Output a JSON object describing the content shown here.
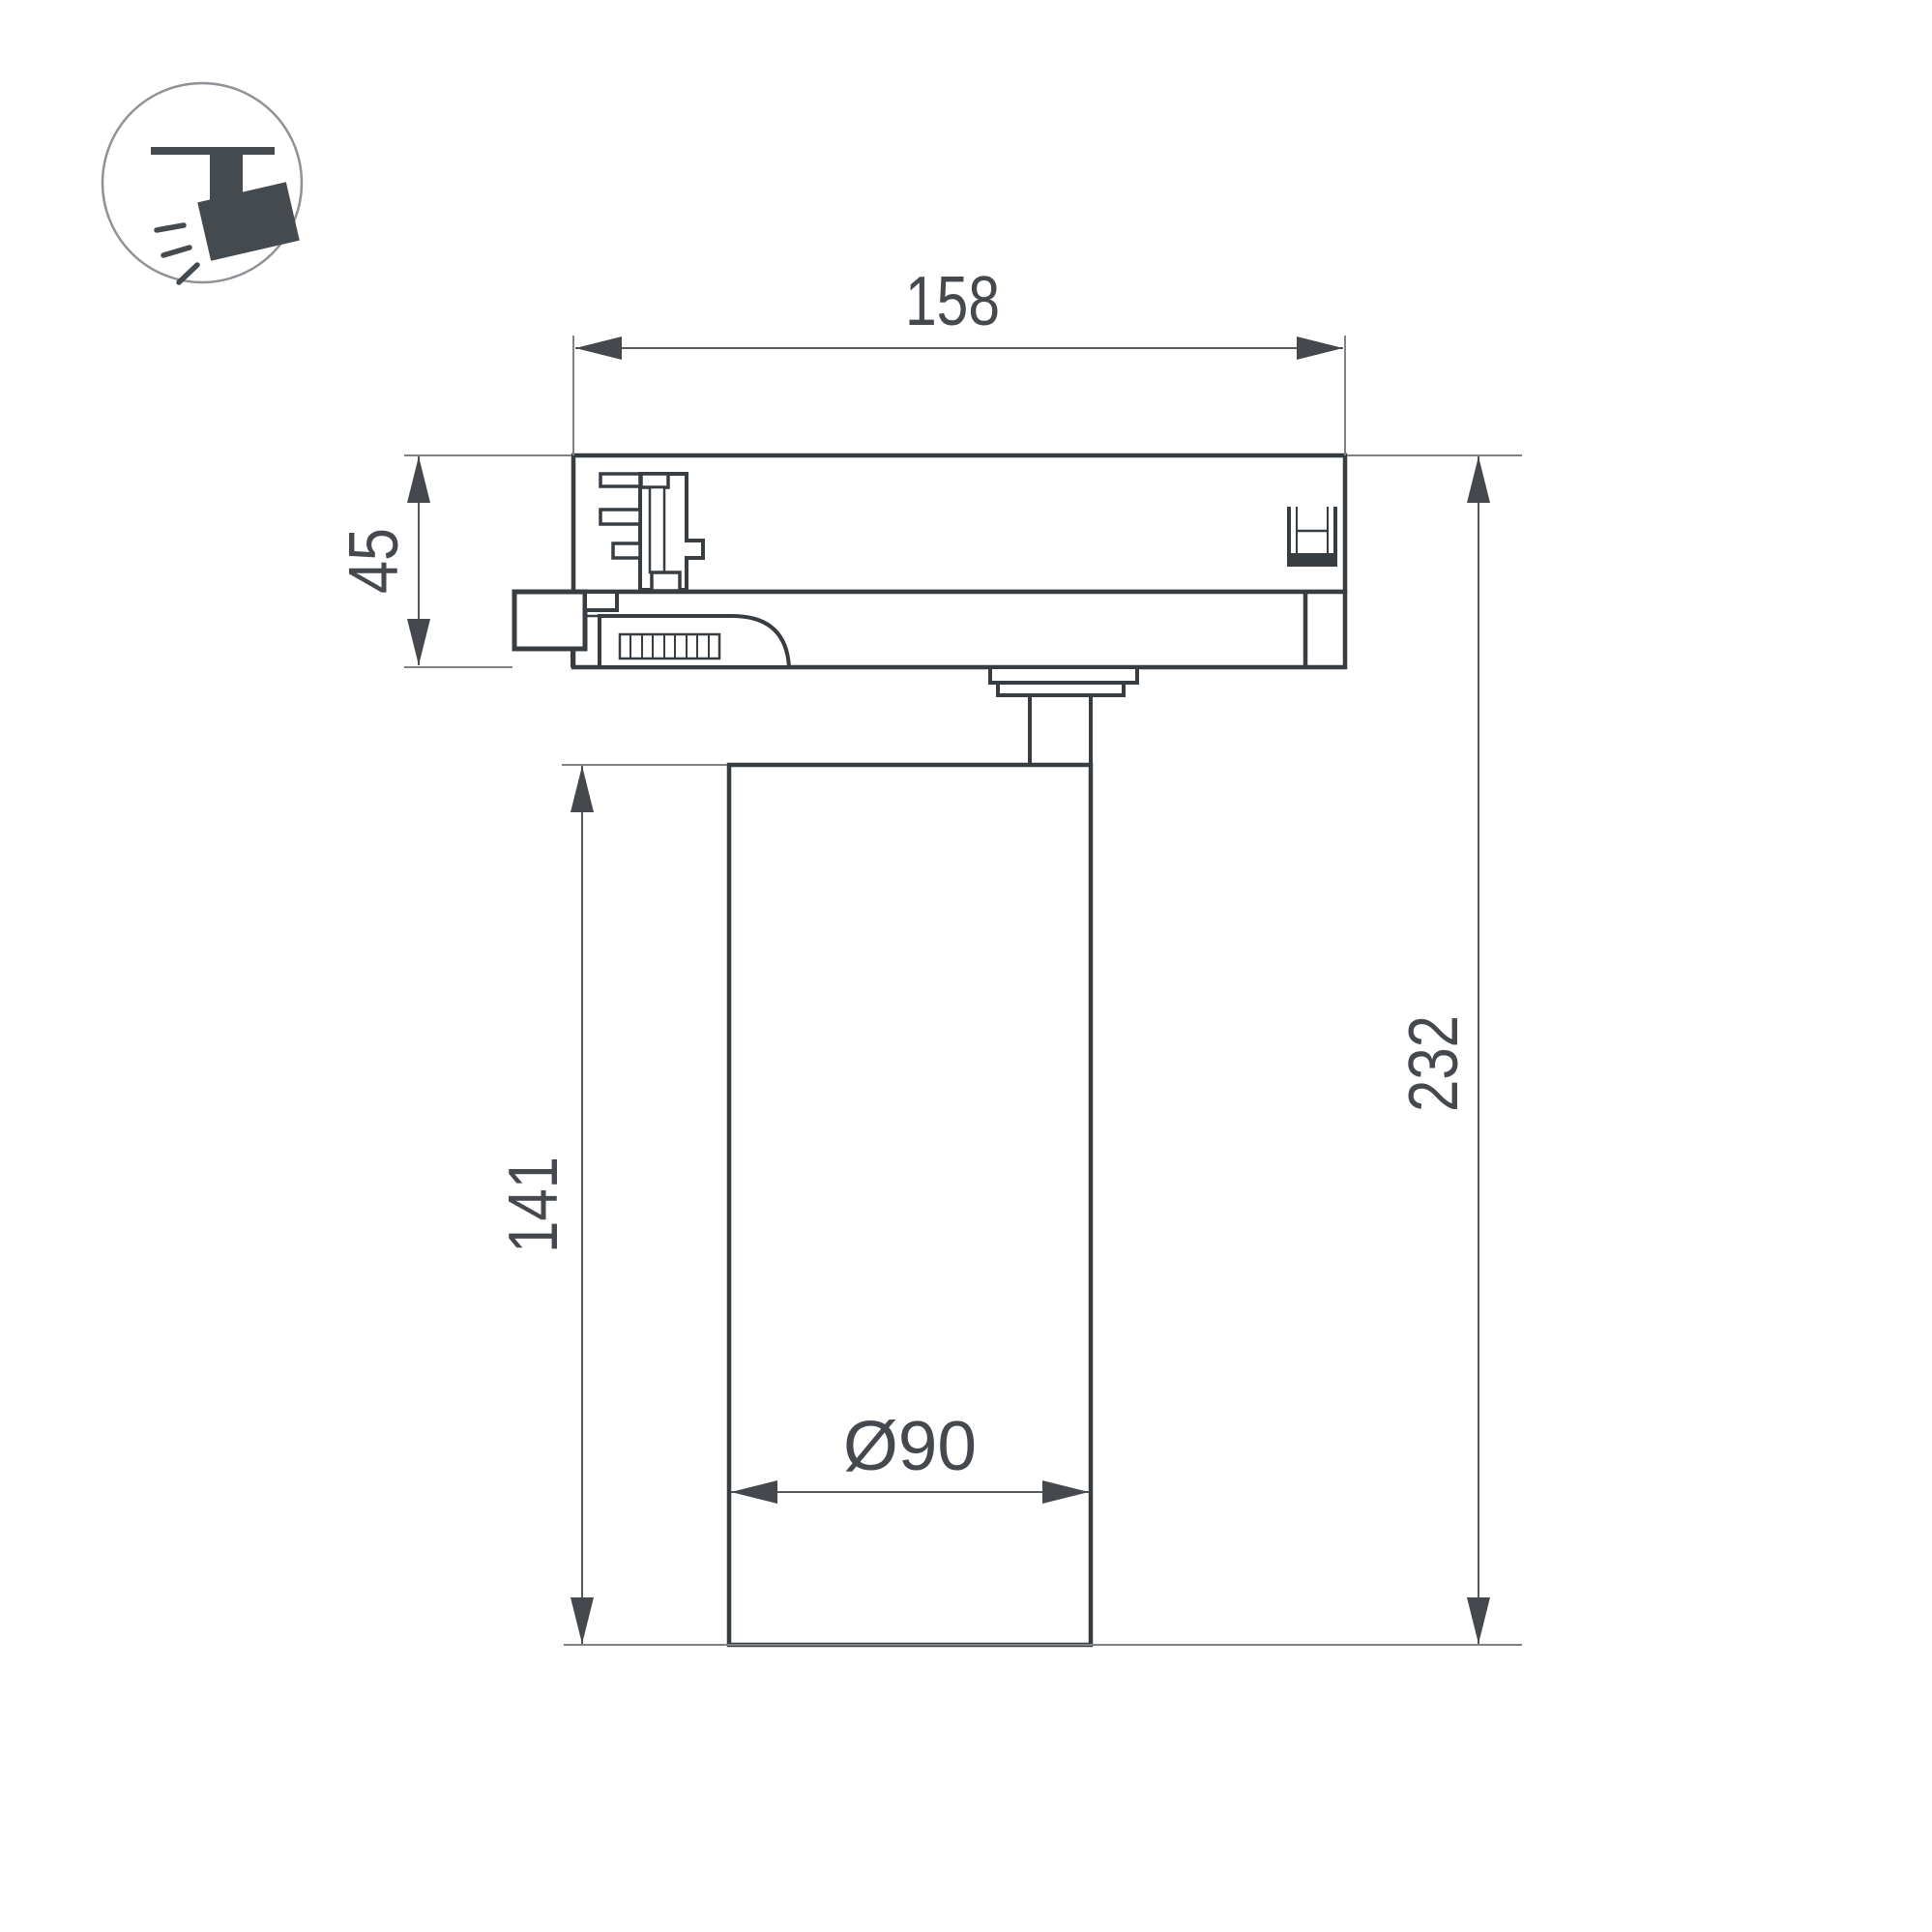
{
  "drawing": {
    "labels": {
      "adapter_width": "158",
      "adapter_height": "45",
      "overall_height": "232",
      "body_height": "141",
      "body_diameter": "Ø90"
    },
    "colors": {
      "outline": "#383d42",
      "dimension": "#55595d",
      "extension": "#7e8286",
      "label": "#45494e",
      "icon": "#454a4f",
      "background": "#ffffff"
    },
    "icon": {
      "name": "track-spotlight-icon"
    }
  }
}
